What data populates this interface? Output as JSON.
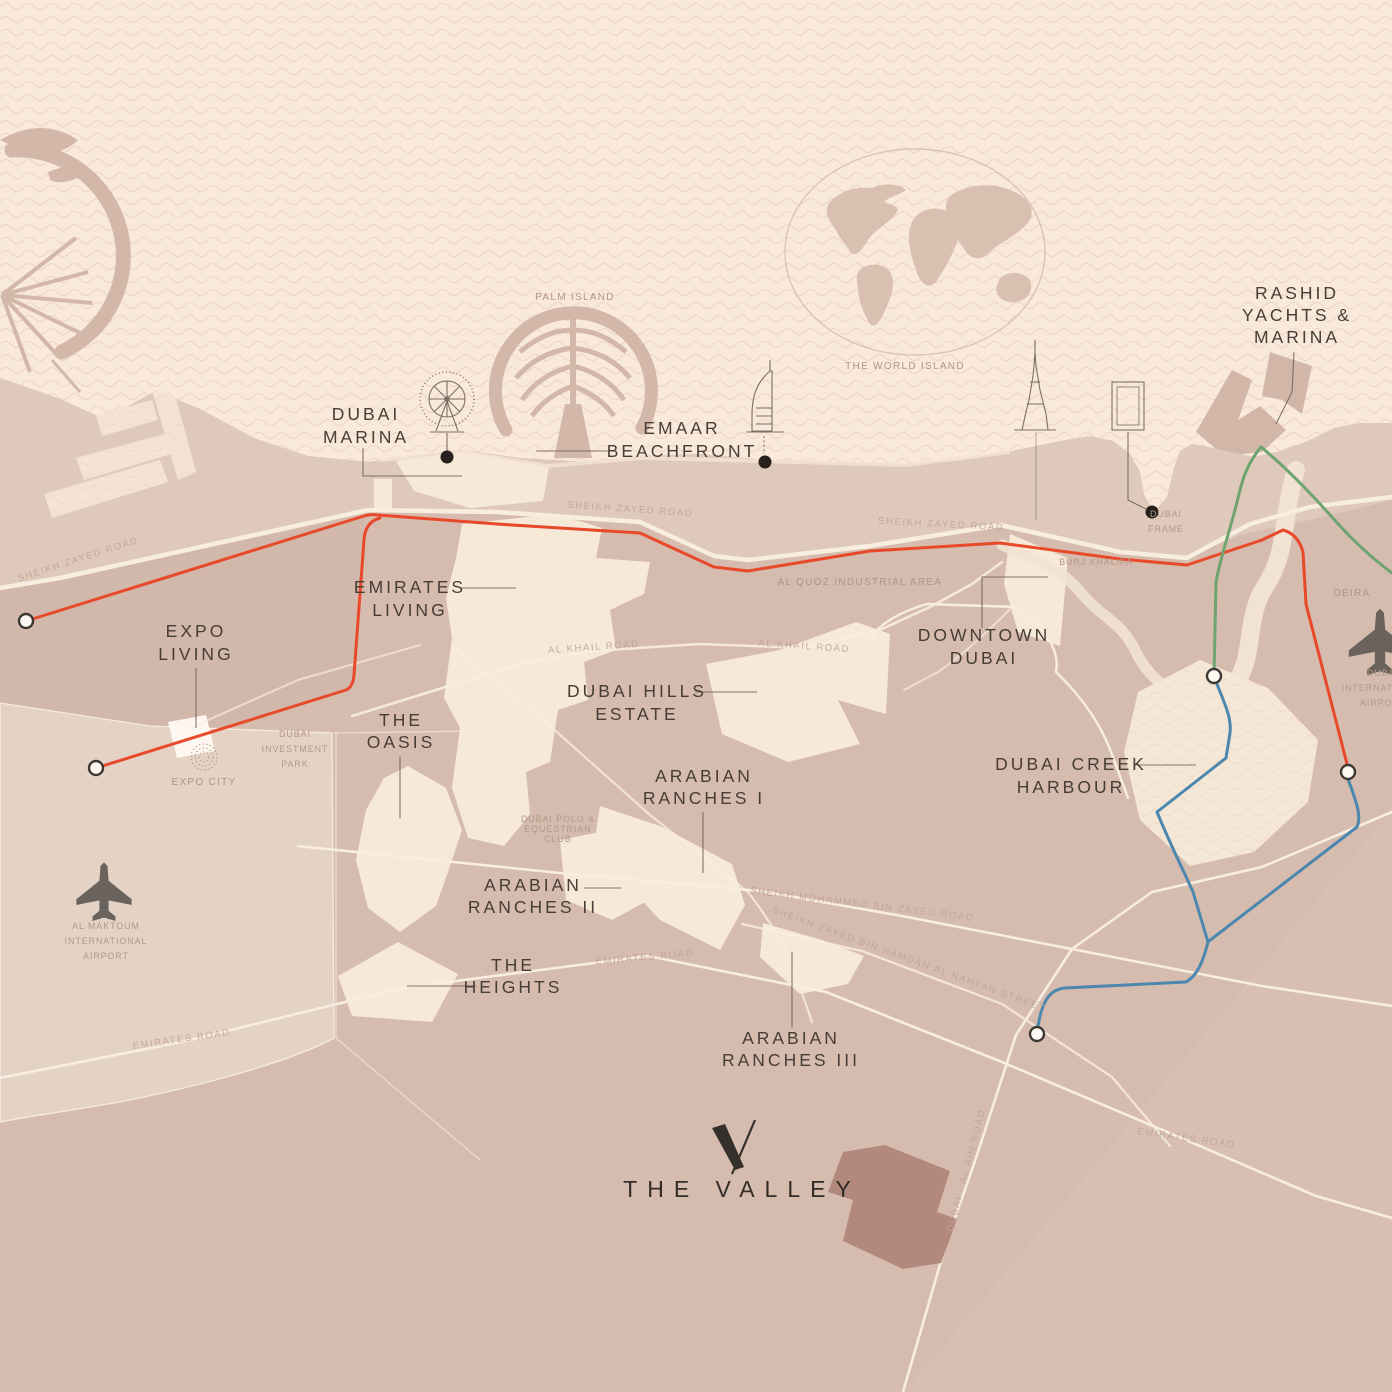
{
  "brand": {
    "name": "THE VALLEY",
    "logo": "valley-v-mark"
  },
  "colors": {
    "sea": "#f9e9da",
    "wave": "#ecd2c0",
    "land": "#d6bcae",
    "coast_band": "#e1ccbd",
    "parcel": "#f7e9d8",
    "airport_zone": "#e4d2c5",
    "valley_parcel": "#b3897d",
    "route_red": "#e8492b",
    "route_green": "#6fa46f",
    "route_blue": "#4c87ae",
    "road": "#f8ede1",
    "label_dark": "#463d36",
    "label_muted": "#b09585",
    "marker": "#26211d"
  },
  "places": [
    {
      "id": "dubai-marina",
      "lines": [
        "DUBAI",
        "MARINA"
      ]
    },
    {
      "id": "emaar-beachfront",
      "lines": [
        "EMAAR",
        "BEACHFRONT"
      ]
    },
    {
      "id": "rashid-yachts-marina",
      "lines": [
        "RASHID",
        "YACHTS &",
        "MARINA"
      ]
    },
    {
      "id": "emirates-living",
      "lines": [
        "EMIRATES",
        "LIVING"
      ]
    },
    {
      "id": "expo-living",
      "lines": [
        "EXPO",
        "LIVING"
      ]
    },
    {
      "id": "downtown-dubai",
      "lines": [
        "DOWNTOWN",
        "DUBAI"
      ]
    },
    {
      "id": "dubai-hills-estate",
      "lines": [
        "DUBAI HILLS",
        "ESTATE"
      ]
    },
    {
      "id": "the-oasis",
      "lines": [
        "THE",
        "OASIS"
      ]
    },
    {
      "id": "arabian-ranches-i",
      "lines": [
        "ARABIAN",
        "RANCHES I"
      ]
    },
    {
      "id": "arabian-ranches-ii",
      "lines": [
        "ARABIAN",
        "RANCHES II"
      ]
    },
    {
      "id": "dubai-creek-harbour",
      "lines": [
        "DUBAI CREEK",
        "HARBOUR"
      ]
    },
    {
      "id": "the-heights",
      "lines": [
        "THE",
        "HEIGHTS"
      ]
    },
    {
      "id": "arabian-ranches-iii",
      "lines": [
        "ARABIAN",
        "RANCHES III"
      ]
    }
  ],
  "landmarks": [
    {
      "id": "palm-island",
      "text": "PALM ISLAND"
    },
    {
      "id": "world-island",
      "text": "THE WORLD ISLAND"
    },
    {
      "id": "al-quoz",
      "text": "AL QUOZ INDUSTRIAL AREA"
    },
    {
      "id": "burj-khalifa",
      "text": "BURJ KHALIFA"
    },
    {
      "id": "dubai-frame",
      "lines": [
        "DUBAI",
        "FRAME"
      ]
    },
    {
      "id": "deira",
      "text": "DEIRA"
    },
    {
      "id": "dubai-investment-park",
      "lines": [
        "DUBAI",
        "INVESTMENT",
        "PARK"
      ]
    },
    {
      "id": "expo-city",
      "text": "EXPO CITY"
    },
    {
      "id": "al-maktoum-airport",
      "lines": [
        "AL MAKTOUM",
        "INTERNATIONAL",
        "AIRPORT"
      ]
    },
    {
      "id": "dubai-polo-club",
      "lines": [
        "DUBAI POLO &",
        "EQUESTRIAN",
        "CLUB"
      ]
    },
    {
      "id": "dubai-intl-airport",
      "lines": [
        "DUBAI",
        "INTERNATIONAL",
        "AIRPORT"
      ]
    }
  ],
  "roads": [
    {
      "id": "szr-west",
      "text": "SHEIKH ZAYED ROAD"
    },
    {
      "id": "szr-mid",
      "text": "SHEIKH ZAYED ROAD"
    },
    {
      "id": "szr-east",
      "text": "SHEIKH ZAYED ROAD"
    },
    {
      "id": "al-khail-west",
      "text": "AL KHAIL ROAD"
    },
    {
      "id": "al-khail-east",
      "text": "AL KHAIL ROAD"
    },
    {
      "id": "smbz",
      "text": "SHEIKH MOHAMMED BIN ZAYED ROAD"
    },
    {
      "id": "szbh",
      "text": "SHEIKH ZAYED BIN HAMDAN AL NAHYAN STREET"
    },
    {
      "id": "emirates-west",
      "text": "EMIRATES ROAD"
    },
    {
      "id": "emirates-mid",
      "text": "EMIRATES ROAD"
    },
    {
      "id": "emirates-east",
      "text": "EMIRATES ROAD"
    },
    {
      "id": "dubai-al-ain",
      "text": "DUBAI - AL AIN ROAD"
    }
  ]
}
